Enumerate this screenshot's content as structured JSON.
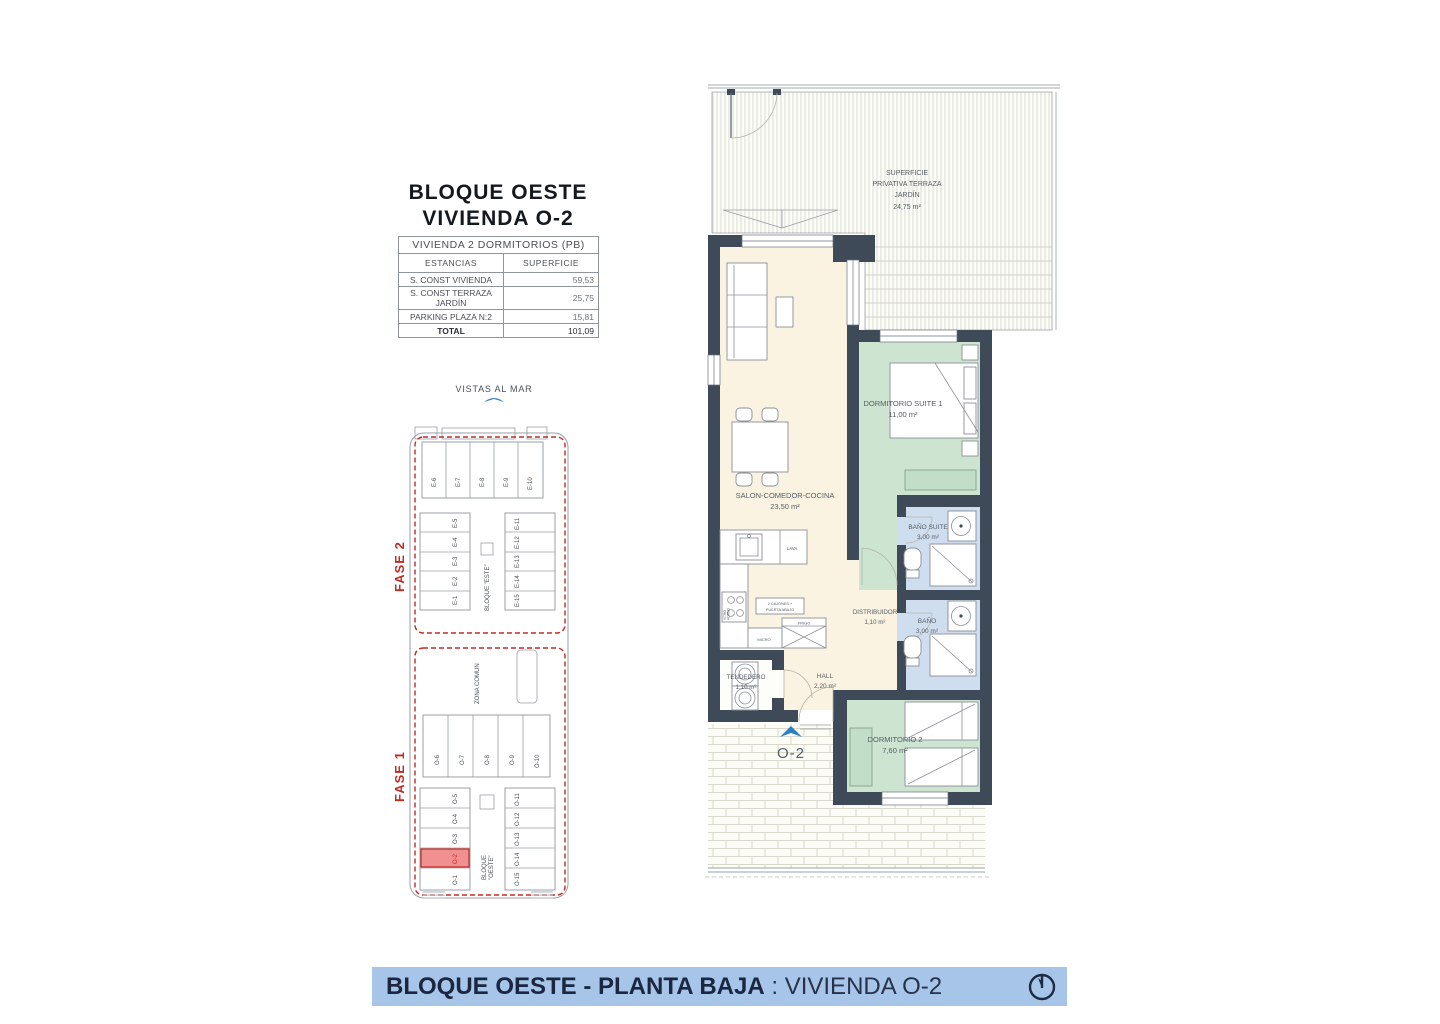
{
  "header": {
    "title_line1": "BLOQUE OESTE",
    "title_line2": "VIVIENDA O-2"
  },
  "table": {
    "header": "VIVIENDA 2 DORMITORIOS (PB)",
    "col_estancias": "ESTANCIAS",
    "col_superficie": "SUPERFICIE",
    "rows": [
      {
        "label": "S. CONST VIVIENDA",
        "value": "59,53"
      },
      {
        "label": "S. CONST TERRAZA JARDÍN",
        "value": "25,75"
      },
      {
        "label": "PARKING   PLAZA   N:2",
        "value": "15,81"
      },
      {
        "label": "TOTAL",
        "value": "101,09"
      }
    ]
  },
  "siteplan": {
    "vistas": "VISTAS AL MAR",
    "zona_comun": "ZONA COMUN",
    "fase2": {
      "label": "FASE 2",
      "top": [
        "E-6",
        "E-7",
        "E-8",
        "E-9",
        "E-10"
      ],
      "left": [
        "E-5",
        "E-4",
        "E-3",
        "E-2",
        "E-1"
      ],
      "right": [
        "E-11",
        "E-12",
        "E-13",
        "E-14",
        "E-15"
      ],
      "block": "BLOQUE \"ESTE\""
    },
    "fase1": {
      "label": "FASE 1",
      "top": [
        "O-6",
        "O-7",
        "O-8",
        "O-9",
        "O-10"
      ],
      "left": [
        "O-5",
        "O-4",
        "O-3",
        "O-2",
        "O-1"
      ],
      "right": [
        "O-11",
        "O-12",
        "O-13",
        "O-14",
        "O-15"
      ],
      "block_line1": "BLOQUE",
      "block_line2": "\"OESTE\"",
      "highlighted_unit": "O-2"
    }
  },
  "floorplan": {
    "terraza": {
      "l1": "SUPERFICIE",
      "l2": "PRIVATIVA TERRAZA",
      "l3": "JARDÍN",
      "area": "24,75 m²"
    },
    "salon": {
      "name": "SALON-COMEDOR-COCINA",
      "area": "23,50 m²"
    },
    "suite": {
      "name": "DORMITORIO SUITE 1",
      "area": "11,00 m²"
    },
    "bano_suite": {
      "name": "BAÑO SUITE",
      "area": "3,00 m²"
    },
    "bano": {
      "name": "BAÑO",
      "area": "3,00 m²"
    },
    "distribuidor": {
      "name": "DISTRIBUIDOR",
      "area": "1,10 m²"
    },
    "hall": {
      "name": "HALL",
      "area": "2,20 m²"
    },
    "tendedero": {
      "name": "TENDEDERO",
      "area": "1,10 m²"
    },
    "dorm2": {
      "name": "DORMITORIO 2",
      "area": "7,60 m²"
    },
    "kitchen": {
      "lava": "LAVA",
      "caldera": "CALDERA",
      "vitro": "VITRO",
      "horno": "HORNO",
      "cajones1": "2 CAJONES +",
      "cajones2": "PUERTA ABAJO",
      "frigo": "FRIGO",
      "micro": "MICRO"
    },
    "unit_marker": "O-2"
  },
  "footer": {
    "title_bold": "BLOQUE OESTE - PLANTA BAJA",
    "separator": " : ",
    "title_regular": "VIVIENDA O-2"
  },
  "colors": {
    "accent-red": "#c22a23",
    "wall": "#3e4a58",
    "room-cream": "#faf3e2",
    "room-green": "#cde4d0",
    "room-blue": "#cfdeee",
    "footer-bg": "#a6c5e8",
    "marker-blue": "#2e7fc2",
    "marker-text": "#5ba0d2"
  }
}
